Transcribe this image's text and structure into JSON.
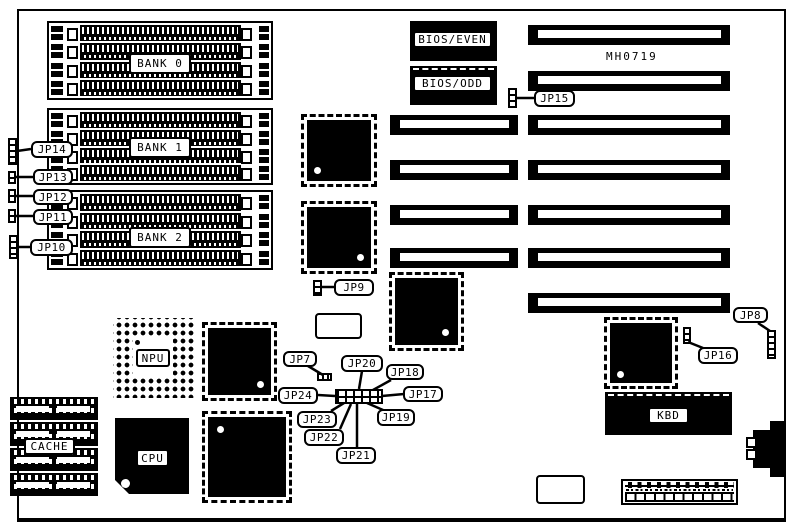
{
  "diagram": {
    "model_label": "MH0719",
    "memory_banks": [
      {
        "label": "BANK 0"
      },
      {
        "label": "BANK 1"
      },
      {
        "label": "BANK 2"
      }
    ],
    "chips": {
      "bios_even": "BIOS/EVEN",
      "bios_odd": "BIOS/ODD",
      "npu": "NPU",
      "cpu": "CPU",
      "cache": "CACHE",
      "kbd": "KBD"
    },
    "jumpers": {
      "jp7": "JP7",
      "jp8": "JP8",
      "jp9": "JP9",
      "jp10": "JP10",
      "jp11": "JP11",
      "jp12": "JP12",
      "jp13": "JP13",
      "jp14": "JP14",
      "jp15": "JP15",
      "jp16": "JP16",
      "jp17": "JP17",
      "jp18": "JP18",
      "jp19": "JP19",
      "jp20": "JP20",
      "jp21": "JP21",
      "jp22": "JP22",
      "jp23": "JP23",
      "jp24": "JP24"
    }
  }
}
